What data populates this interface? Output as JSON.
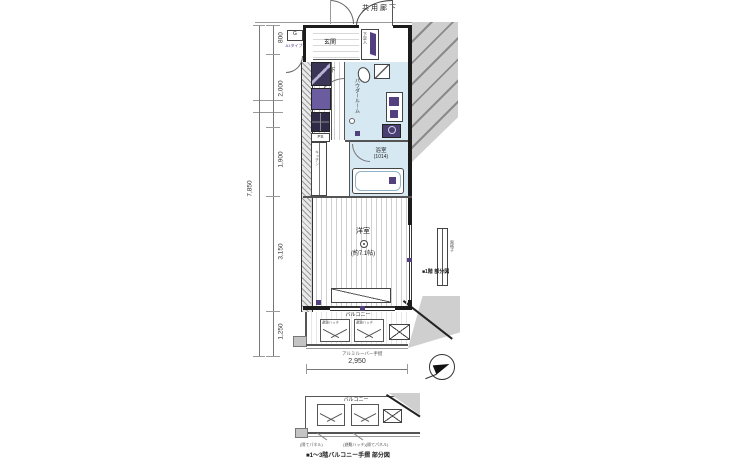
{
  "colors": {
    "wet_area": "#d6e8f2",
    "fixture_purple": "#53407e",
    "area_gray": "#cfcfcf",
    "wall": "#1c1c1c"
  },
  "labels": {
    "common_corridor": "共用廊下",
    "entrance": "玄関",
    "shoe_box": "下足入",
    "hallway": "廊下",
    "powder_room": "パウダールーム",
    "bath_name": "浴室",
    "bath_size": "(1014)",
    "room_name": "洋室",
    "room_size": "(約7.1帖)",
    "balcony": "バルコニー",
    "handrail": "アルミルーバー手摺",
    "ps": "PS",
    "gas": "G",
    "unit_type": "A1タイプ",
    "kitchen": "キッチン",
    "hatch": "避難ハッチ",
    "window_detail_caption": "■1階 部分図",
    "window_detail_label": "面格子",
    "balcony_detail_caption": "■1〜3階バルコニー手摺 部分図",
    "balcony_detail_label": "バルコニー",
    "balcony_detail_note_left": "(隔てパネル)",
    "balcony_detail_note_right": "(避難ハッチ)(隔てパネル)"
  },
  "dimensions": {
    "left": [
      "800",
      "2,000",
      "1,900",
      "3,150",
      "1,250"
    ],
    "total_left": "7,850",
    "bottom_width": "2,950"
  }
}
